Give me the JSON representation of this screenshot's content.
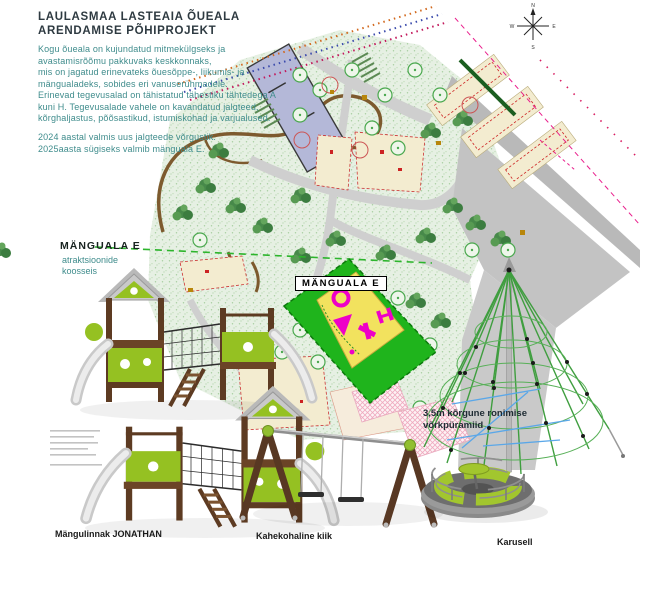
{
  "header": {
    "title_lines": [
      "LAULASMAA LASTEAIA ÕUEALA",
      "ARENDAMISE PÕHIPROJEKT"
    ],
    "paragraph1_lines": [
      "Kogu õueala on kujundatud mitmekülgseks ja",
      "avastamisrõõmu pakkuvaks keskkonnaks,",
      "mis on jagatud erinevateks õuesõppe-, liikumis- ja",
      "mängualadeks, sobides eri vanuserühmadele."
    ],
    "paragraph2_lines": [
      "Erinevad tegevusalad on tähistatud tähestiku tähtedega A",
      "kuni H. Tegevusalade vahele on kavandatud jalgteed,",
      "kõrghaljastus, põõsastikud, istumiskohad ja varjualused."
    ],
    "paragraph3_lines": [
      "2024 aastal valmis uus jalgteede võrgustik.",
      "2025aasta sügiseks valmib mänguala E."
    ]
  },
  "sidebar_label": {
    "heading": "MÄNGUALA E",
    "sub_lines": [
      "atraktsioonide",
      "koosseis"
    ]
  },
  "map": {
    "zone_label": "MÄNGUALA E",
    "compass": {
      "n": "N",
      "e": "E",
      "s": "S",
      "w": "W"
    }
  },
  "equipment": {
    "castle_caption": "Mängulinnak JONATHAN",
    "swing_caption": "Kahekohaline kiik",
    "carousel_caption": "Karusell",
    "pyramid_label_lines": [
      "3,5m kõrgune ronimise",
      "võrkpüramiid"
    ]
  },
  "colors": {
    "teal_text": "#3f8c8c",
    "title_text": "#2e3a41",
    "zone_green": "#1fb41c",
    "zone_pad_yellow": "#f2e25e",
    "magenta_marker": "#ee00c8",
    "equipment_lime": "#95c122",
    "equipment_brown": "#5d3b22",
    "building_lavender": "#b4b8d8"
  }
}
